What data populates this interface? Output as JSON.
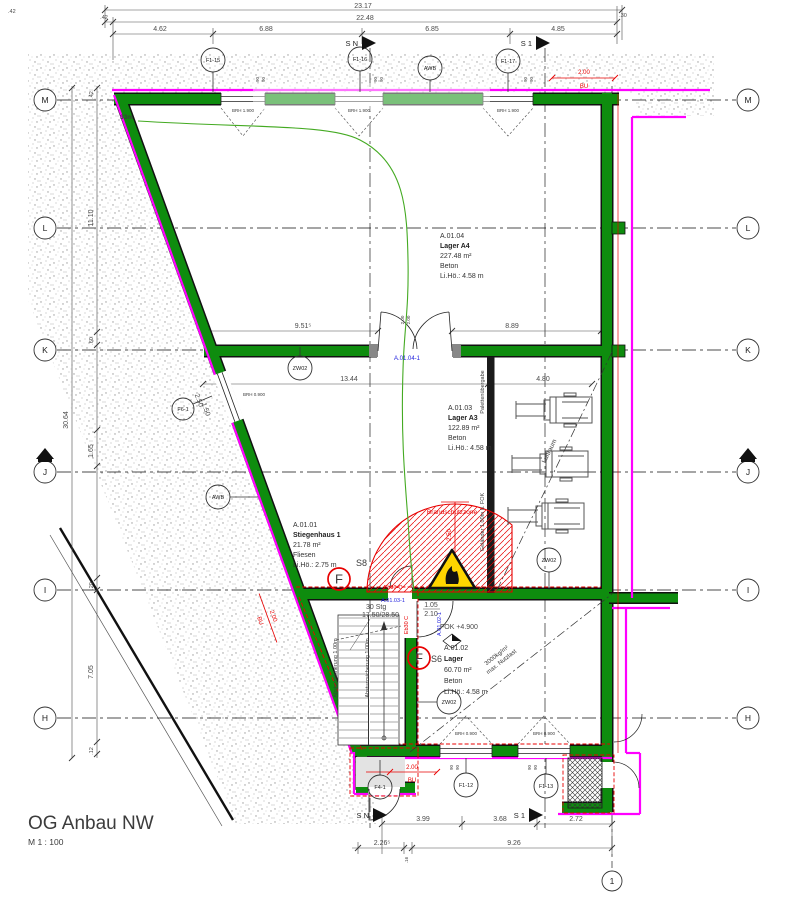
{
  "title": {
    "name": "OG Anbau NW",
    "scale": "M 1 : 100"
  },
  "grid": {
    "rows": [
      "M",
      "L",
      "K",
      "J",
      "I",
      "H"
    ],
    "col": "1"
  },
  "sections": {
    "sn": "S N",
    "s1": "S 1"
  },
  "dims": {
    "top": {
      "total": "23.17",
      "subtotal": "22.48",
      "off_l": ".42",
      "off_r": ".30",
      "corner": ".42",
      "s1": "4.62",
      "s2": "6.88",
      "s3": "6.85",
      "s4": "4.85"
    },
    "left": {
      "overall": "30.64",
      "off": ".42",
      "s1": "11.10",
      "s2": ".60",
      "s3": "1.65",
      "s4": ".20",
      "s5": "7.05",
      "s6": ".12"
    },
    "bottom": {
      "s1": "3.99",
      "s2": "3.68",
      "s3": "2.72",
      "a": "2.26⁵",
      "gap": ".16",
      "b": "9.26"
    },
    "inner": {
      "k_l": "9.51⁵",
      "k_r": "8.89",
      "i_l": "13.44",
      "i_r": "4.80",
      "door_w": "1.05",
      "door_h": "2.10",
      "leaf": "2.00",
      "win_w": "2.50",
      "win_h": "1.50",
      "tag": "90"
    },
    "red": {
      "val": "2.00",
      "note": "BU"
    }
  },
  "rooms": {
    "a0104": {
      "id": "A.01.04",
      "name": "Lager A4",
      "area": "227.48 m²",
      "finish": "Beton",
      "height": "Li.Hö.: 4.58 m"
    },
    "a0103": {
      "id": "A.01.03",
      "name": "Lager A3",
      "area": "122.89 m²",
      "finish": "Beton",
      "height": "Li.Hö.: 4.58 m"
    },
    "a0101": {
      "id": "A.01.01",
      "name": "Stiegenhaus 1",
      "area": "21.78 m²",
      "finish": "Fliesen",
      "height": "Li.Hö.: 2.75 m"
    },
    "a0102": {
      "id": "A.01.02",
      "name": "Lager",
      "area": "60.70 m²",
      "finish": "Beton",
      "height": "Li.Hö.: 4.58 m"
    }
  },
  "markers": {
    "f1_15": "F1-15",
    "f1_16": "F1-16",
    "f1_17": "F1-17",
    "awb": "AWB",
    "zw02": "ZW02",
    "f4_1": "F4-1",
    "f1_12": "F1-12",
    "f1_13": "F1-13",
    "f6_1": "F6-1",
    "fire": "F",
    "s8": "S8",
    "s6": "S6"
  },
  "notes": {
    "escape": "33m",
    "zone": "Brandschutzzone",
    "zone_r": "2.50",
    "eb30": "Eb30-C",
    "eb30b": "Eb30 C",
    "door04": "A.01.04-1",
    "door03": "A.01.03-1",
    "door02": "A.01.02-1",
    "stg": "30 Stg",
    "stg2": "17.50/28.50",
    "guard": "Absturzsicherung 1.00m",
    "rail": "Geländer 1.00m ü. FOK",
    "pallet": "Palettenübergabe",
    "air": "Luftraum",
    "load1": "3000kg/m²",
    "load2": "max. Nutzlast",
    "fok": "FOK +4.900",
    "brh_t": "BRH 1.900",
    "brh_b": "BRH 0.900"
  },
  "colors": {
    "wall": "#0e8c0e",
    "facade": "#ff00ff",
    "alert": "#e80000",
    "door_label": "#2020dd",
    "escape": "#44aa22"
  }
}
